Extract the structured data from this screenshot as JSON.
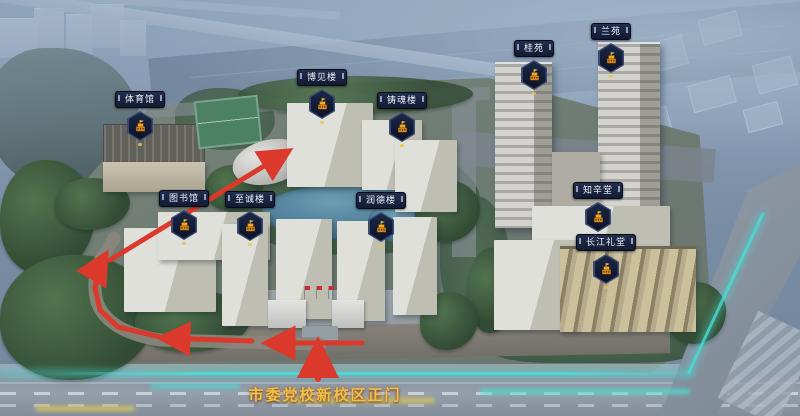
{
  "map": {
    "gate_label": "市委党校新校区正门",
    "pois": [
      {
        "id": "gymnasium",
        "label": "体育馆",
        "icon": "building-badge-icon",
        "x": 140,
        "y": 91
      },
      {
        "id": "library",
        "label": "图书馆",
        "icon": "building-badge-icon",
        "x": 184,
        "y": 190
      },
      {
        "id": "zhicheng-building",
        "label": "至诚楼",
        "icon": "building-badge-icon",
        "x": 250,
        "y": 191
      },
      {
        "id": "bojian-building",
        "label": "博见楼",
        "icon": "building-badge-icon",
        "x": 322,
        "y": 69
      },
      {
        "id": "zhuhun-building",
        "label": "铸魂楼",
        "icon": "building-badge-icon",
        "x": 402,
        "y": 92
      },
      {
        "id": "runde-building",
        "label": "润德楼",
        "icon": "building-badge-icon",
        "x": 381,
        "y": 192
      },
      {
        "id": "gui-yuan",
        "label": "桂苑",
        "icon": "building-badge-icon",
        "x": 534,
        "y": 40
      },
      {
        "id": "lan-yuan",
        "label": "兰苑",
        "icon": "building-badge-icon",
        "x": 611,
        "y": 23
      },
      {
        "id": "zhixin-hall",
        "label": "知辛堂",
        "icon": "building-badge-icon",
        "x": 598,
        "y": 182
      },
      {
        "id": "changjiang-auditorium",
        "label": "长江礼堂",
        "icon": "building-badge-icon",
        "x": 606,
        "y": 234
      }
    ],
    "route": {
      "color": "#e8301c",
      "segments": [
        {
          "name": "gate-entry-arrow",
          "width": 6,
          "points": [
            [
              318,
              379
            ],
            [
              318,
              345
            ]
          ]
        },
        {
          "name": "south-road-arrow-1",
          "width": 5,
          "points": [
            [
              362,
              343
            ],
            [
              268,
              343
            ]
          ]
        },
        {
          "name": "south-road-arrow-2",
          "width": 5,
          "points": [
            [
              252,
              341
            ],
            [
              163,
              338
            ]
          ]
        },
        {
          "name": "west-curve-arrow",
          "width": 5,
          "points": [
            [
              160,
              337
            ],
            [
              118,
              327
            ],
            [
              100,
              310
            ],
            [
              95,
              288
            ],
            [
              98,
              268
            ],
            [
              105,
              256
            ]
          ]
        },
        {
          "name": "northwest-diagonal-arrow",
          "width": 5,
          "points": [
            [
              110,
              260
            ],
            [
              287,
              152
            ]
          ]
        }
      ]
    },
    "colors": {
      "accent_teal": "#45e8d8",
      "route_red": "#e8301c",
      "label_bg": "#182038",
      "badge_gold": "#f2a823",
      "gate_text_gold": "#edc24a"
    }
  }
}
